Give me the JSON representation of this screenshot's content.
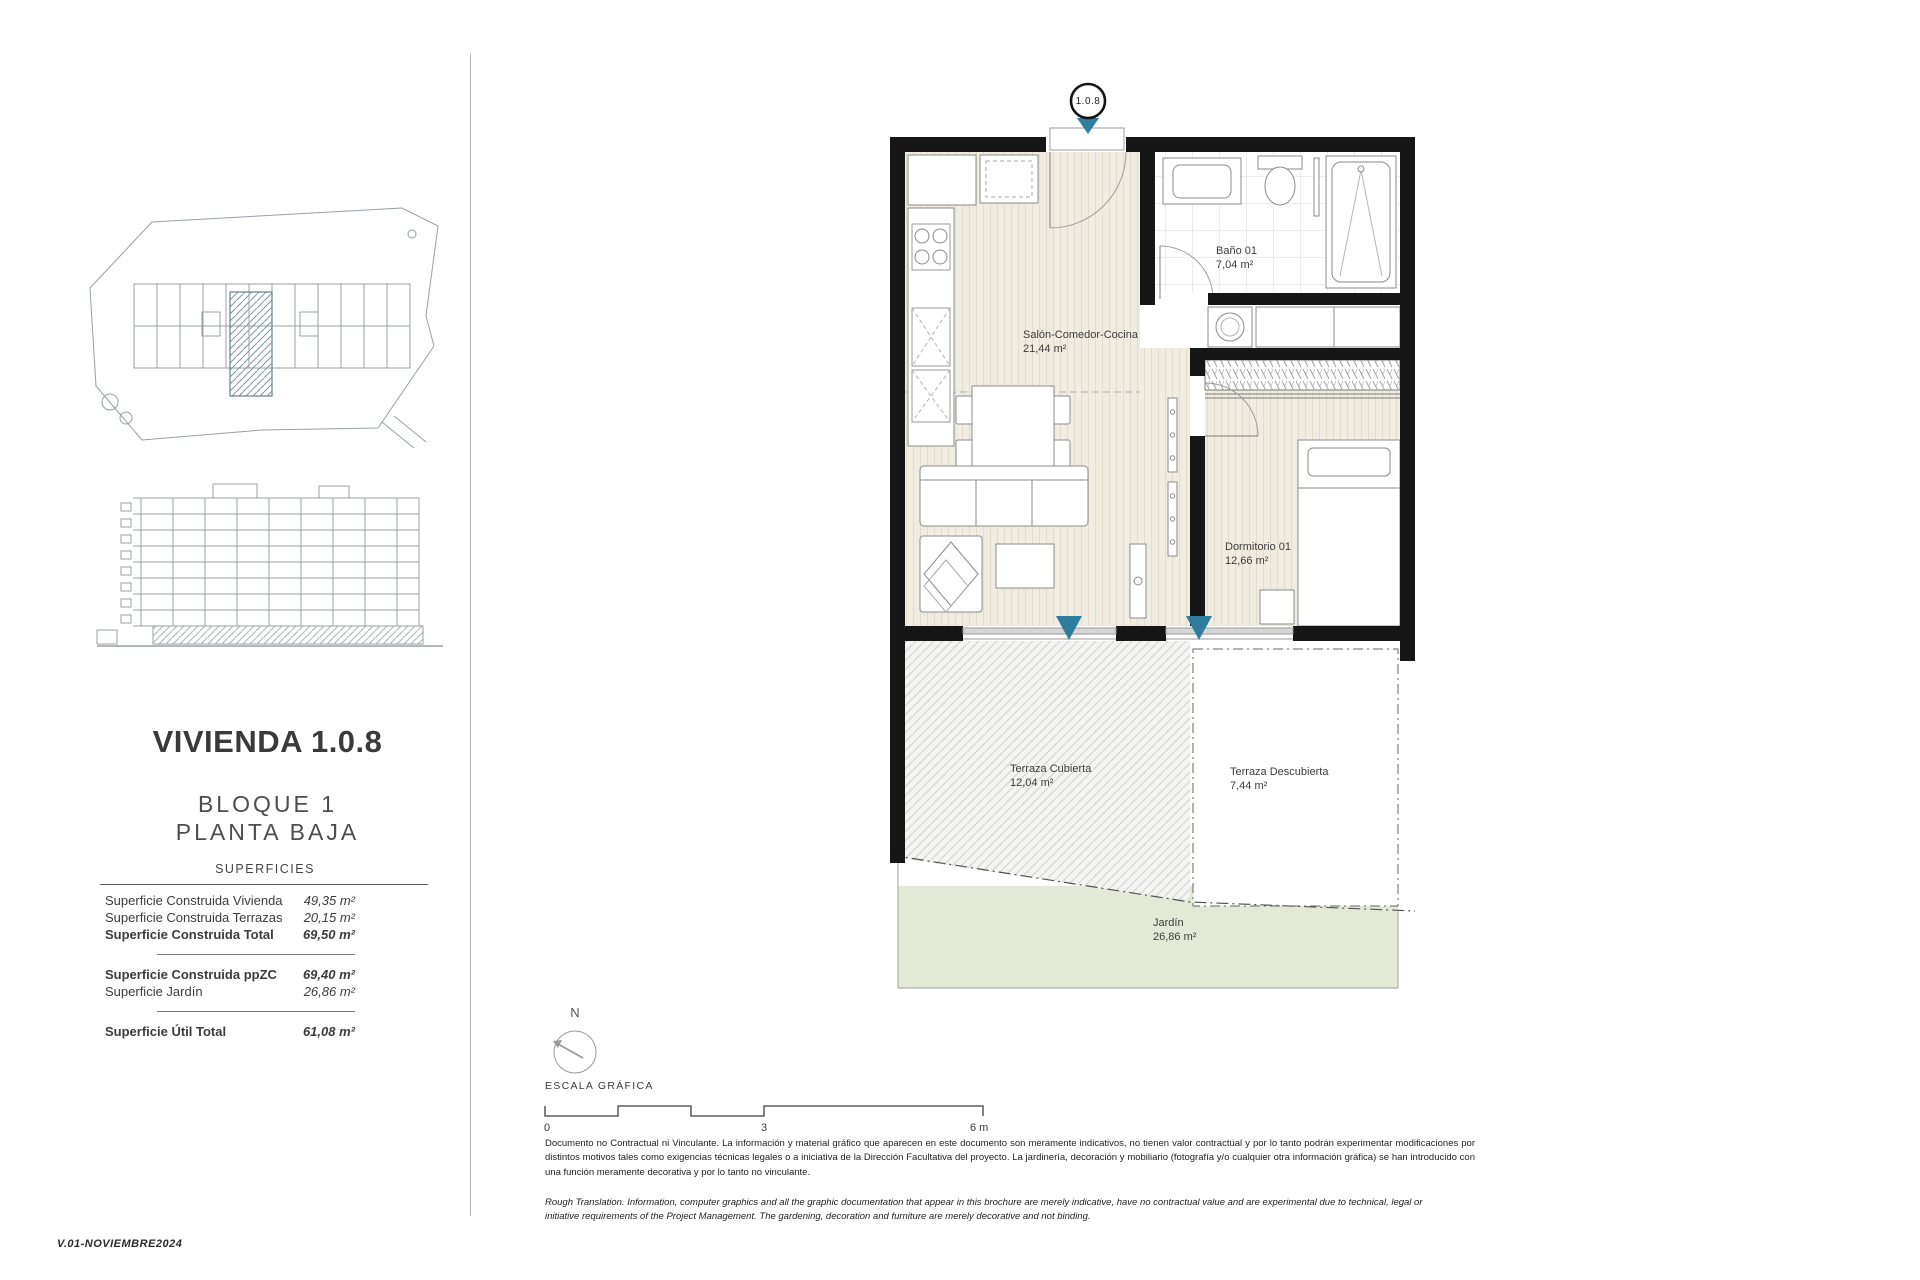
{
  "sidebar": {
    "title": "VIVIENDA 1.0.8",
    "block": "BLOQUE 1",
    "floor": "PLANTA BAJA",
    "surfaces_header": "SUPERFICIES",
    "rows": [
      {
        "label": "Superficie Construida Vivienda",
        "value": "49,35 m²"
      },
      {
        "label": "Superficie Construida Terrazas",
        "value": "20,15 m²"
      },
      {
        "label": "Superficie Construida Total",
        "value": "69,50 m²"
      },
      {
        "label": "Superficie Construida ppZC",
        "value": "69,40 m²"
      },
      {
        "label": "Superficie Jardín",
        "value": "26,86 m²"
      },
      {
        "label": "Superficie Útil Total",
        "value": "61,08 m²"
      }
    ]
  },
  "plan": {
    "unit_marker": "1.0.8",
    "rooms": {
      "salon": {
        "name": "Salón-Comedor-Cocina",
        "area": "21,44 m²"
      },
      "bano": {
        "name": "Baño 01",
        "area": "7,04 m²"
      },
      "dormitorio": {
        "name": "Dormitorio 01",
        "area": "12,66 m²"
      },
      "terraza_cubierta": {
        "name": "Terraza Cubierta",
        "area": "12,04 m²"
      },
      "terraza_descubierta": {
        "name": "Terraza Descubierta",
        "area": "7,44 m²"
      },
      "jardin": {
        "name": "Jardín",
        "area": "26,86 m²"
      }
    }
  },
  "scale_bar": {
    "north_label": "N",
    "title": "ESCALA GRÁFICA",
    "ticks": [
      "0",
      "3",
      "6 m"
    ]
  },
  "footer": {
    "disclaimer_es": "Documento no Contractual ni Vinculante. La información y material gráfico que aparecen en este documento son meramente indicativos, no tienen valor contractual y por lo tanto podrán experimentar modificaciones por distintos motivos tales como exigencias técnicas legales o a iniciativa de la Dirección Facultativa del proyecto. La jardinería, decoración y mobiliario (fotografía y/o cualquier otra información gráfica) se han introducido con una función meramente decorativa y por lo tanto no vinculante.",
    "disclaimer_en": "Rough Translation. Information, computer graphics and all the graphic documentation that appear in this brochure are merely indicative, have no contractual value and are experimental due to technical, legal or initiative requirements of the Project Management. The gardening, decoration and furniture are merely decorative and not binding.",
    "version": "V.01-NOVIEMBRE2024"
  },
  "colors": {
    "wall": "#161616",
    "marker_teal": "#2e7d9e",
    "floor_cream": "#f1ece2",
    "garden_green": "#e3e9d6"
  }
}
